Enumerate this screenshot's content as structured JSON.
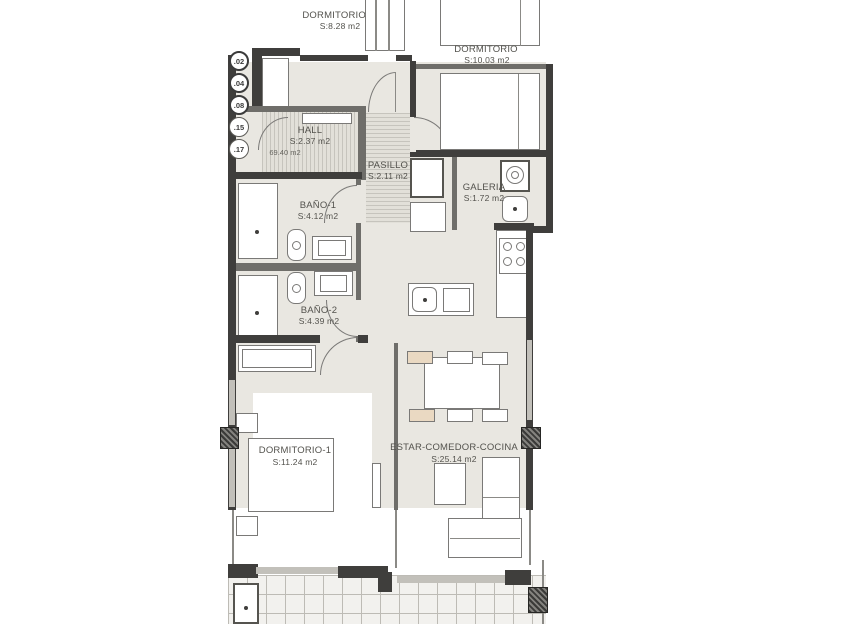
{
  "plan": {
    "type": "apartment-floor-plan",
    "total_area_label": "69.40 m2",
    "badges": [
      ".02",
      ".04",
      ".08",
      ".15",
      ".17"
    ],
    "labels": {
      "dormitorio3": {
        "name": "DORMITORIO -3",
        "area": "S:8.28 m2"
      },
      "dormitorio_top": {
        "name": "DORMITORIO",
        "area": "S:10.03 m2"
      },
      "hall": {
        "name": "HALL",
        "area": "S:2.37 m2"
      },
      "pasillo": {
        "name": "PASILLO",
        "area": "S:2.11 m2"
      },
      "galeria": {
        "name": "GALERIA",
        "area": "S:1.72 m2"
      },
      "bano1": {
        "name": "BAÑO-1",
        "area": "S:4.12 m2"
      },
      "bano2": {
        "name": "BAÑO-2",
        "area": "S:4.39 m2"
      },
      "dormitorio1": {
        "name": "DORMITORIO-1",
        "area": "S:11.24 m2"
      },
      "estar_comedor_cocina": {
        "name": "ESTAR-COMEDOR-COCINA",
        "area": "S:25.14 m2"
      }
    },
    "colors": {
      "floor": "#e9e7e1",
      "wall_dark": "#3f3e3c",
      "line_gray": "#7a7977",
      "hatch_stripe": "#c6c4bd",
      "chair_accent": "#ead9c2",
      "text": "#53524d"
    }
  }
}
